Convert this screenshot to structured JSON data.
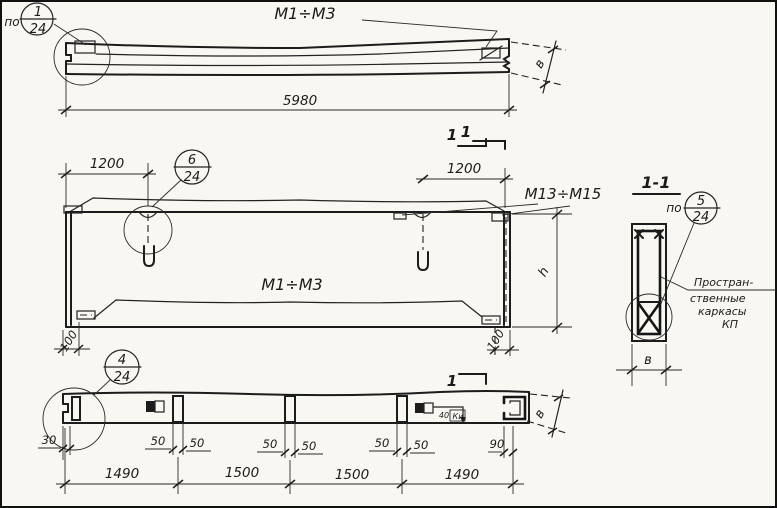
{
  "style": {
    "paper": "#f8f7f2",
    "ink": "#1c1c1c"
  },
  "views": {
    "top": {
      "balloon_prefix": "по",
      "balloon_num": "1",
      "balloon_den": "24",
      "mark": "М1÷М3",
      "dim_length": "5980",
      "dim_width": "в",
      "cut_label": "1"
    },
    "plan": {
      "balloon_num": "6",
      "balloon_den": "24",
      "dim_left": "1200",
      "dim_right": "1200",
      "mark_top": "М13÷М15",
      "mark_mid": "М1÷М3",
      "dim_corner_left": "100",
      "dim_corner_right": "100",
      "dim_height": "h",
      "cut_label": "1"
    },
    "section": {
      "title": "1-1",
      "balloon_prefix": "по",
      "balloon_num": "5",
      "balloon_den": "24",
      "note1": "Простран-",
      "note2": "ственные",
      "note3": "каркасы",
      "note4": "КП",
      "dim_width": "в"
    },
    "bottom": {
      "balloon_num": "4",
      "balloon_den": "24",
      "dim_edge_left": "30",
      "dim_rib1_a": "50",
      "dim_rib1_b": "50",
      "dim_rib2_a": "50",
      "dim_rib2_b": "50",
      "dim_rib3_a": "50",
      "dim_rib3_b": "50",
      "dim_edge_right": "90",
      "dim_embed": "40",
      "embed_mark": "Ки",
      "chain1": "1490",
      "chain2": "1500",
      "chain3": "1500",
      "chain4": "1490",
      "dim_width": "в",
      "cut_label": "1"
    }
  }
}
